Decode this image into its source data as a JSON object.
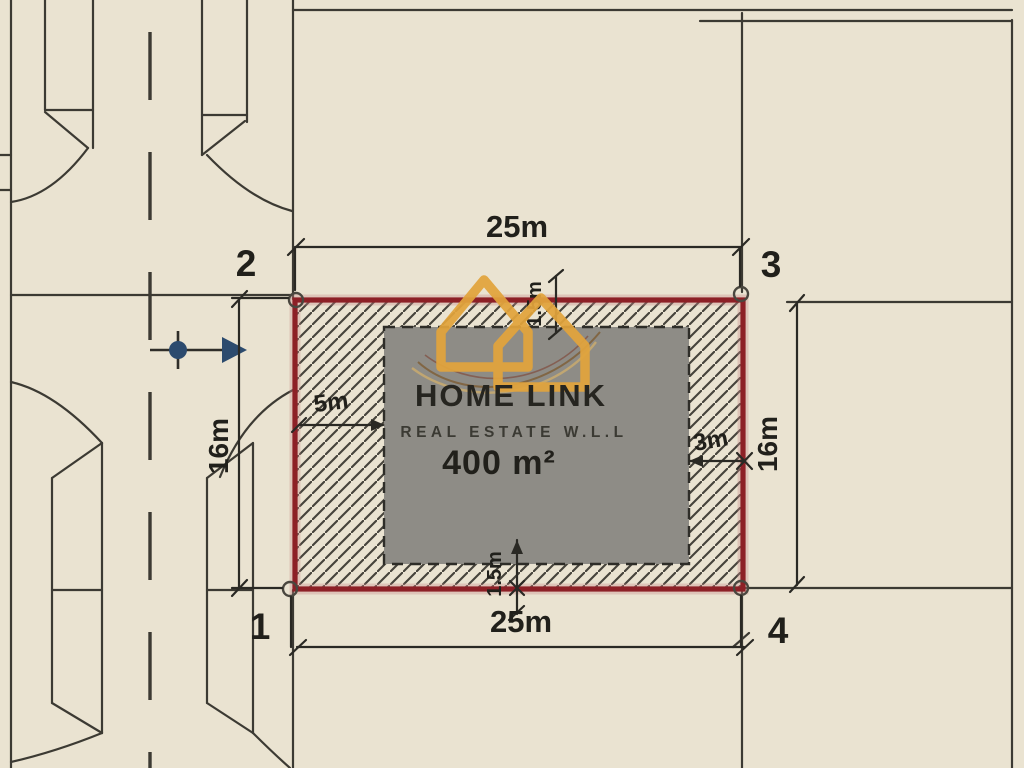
{
  "site_plan": {
    "area": "400 m²",
    "dim_top": "25m",
    "dim_bottom": "25m",
    "dim_left": "16m",
    "dim_right": "16m",
    "setback_left": "5m",
    "setback_right": "3m",
    "setback_top": "1.5m",
    "setback_bottom": "1.5m",
    "corner_top_left": "2",
    "corner_top_right": "3",
    "corner_bottom_left": "1",
    "corner_bottom_right": "4"
  },
  "watermark": {
    "brand": "HOME LINK",
    "tagline": "REAL ESTATE W.L.L"
  },
  "colors": {
    "background": "#eae3d1",
    "line": "#3c3a33",
    "plot_border": "#8d2026",
    "building_fill": "#8e8c86",
    "logo_gold": "#e2a43c",
    "arrow_blue": "#2c4b6e",
    "text": "#21201b"
  }
}
